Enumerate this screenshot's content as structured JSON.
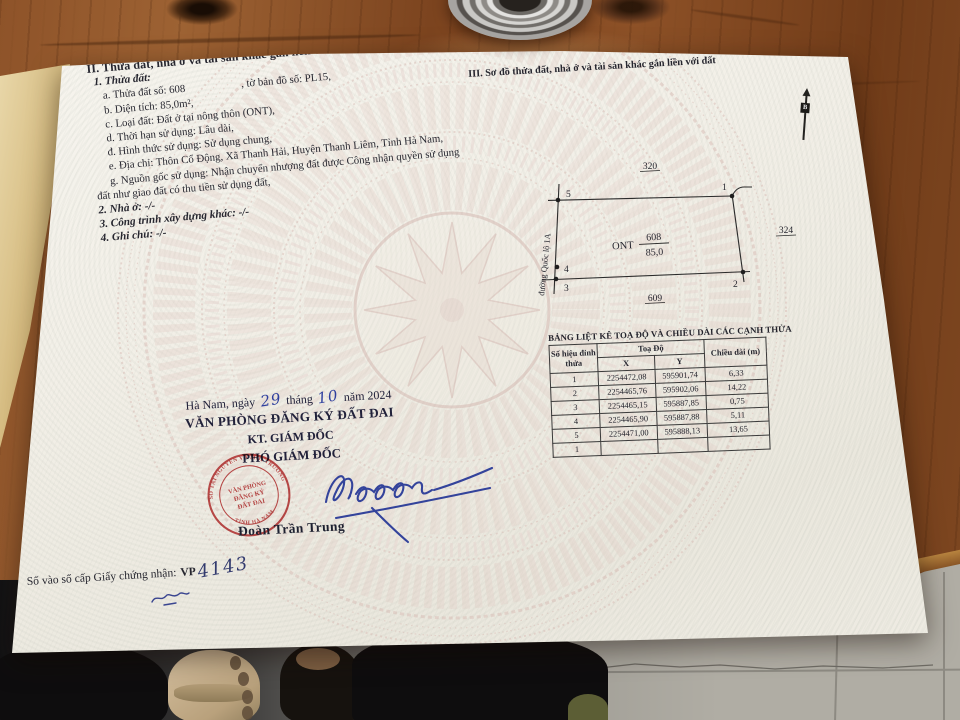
{
  "section2": {
    "heading": "II. Thửa đất, nhà ở và tài sản khác gắn liền với đất",
    "sub1": "1. Thửa đất:",
    "item_a1": "a. Thửa đất số: 608",
    "item_a2": ", tờ bản đồ số: PL15,",
    "item_b": "b. Diện tích: 85,0m²,",
    "item_c": "c. Loại đất: Đất ở tại nông thôn (ONT),",
    "item_d": "d. Thời hạn sử dụng: Lâu dài,",
    "item_dd": "đ. Hình thức sử dụng: Sử dụng chung,",
    "item_e": "e. Địa chỉ: Thôn Cổ Động, Xã Thanh Hải, Huyện Thanh Liêm, Tỉnh Hà Nam,",
    "item_g1": "g. Nguồn gốc sử dụng: Nhận chuyển nhượng đất được Công nhận quyền sử dụng",
    "item_g2": "đất như giao đất có thu tiền sử dụng đất,",
    "sub2": "2. Nhà ở: -/-",
    "sub3": "3. Công trình xây dựng khác: -/-",
    "sub4": "4. Ghi chú: -/-"
  },
  "section3": {
    "heading": "III. Sơ đồ thửa đất, nhà ở và tài sản khác gắn liền với đất",
    "north_label": "B",
    "diagram": {
      "parcel_type": "ONT",
      "parcel_number": "608",
      "parcel_area": "85,0",
      "neighbor_top": "320",
      "neighbor_right": "324",
      "neighbor_bottom": "609",
      "road_label": "đường Quốc lộ 1A",
      "vertex_labels": [
        "1",
        "2",
        "3",
        "4",
        "5"
      ]
    }
  },
  "coord_table": {
    "title": "BẢNG LIỆT KÊ TOẠ ĐỘ VÀ CHIỀU DÀI CÁC CẠNH THỬA",
    "col_vertex": "Số hiệu đỉnh thửa",
    "col_coords": "Toạ Độ",
    "col_x": "X",
    "col_y": "Y",
    "col_length": "Chiều dài (m)",
    "rows": [
      {
        "v": "1",
        "x": "2254472,08",
        "y": "595901,74",
        "len": "6,33"
      },
      {
        "v": "2",
        "x": "2254465,76",
        "y": "595902,06",
        "len": "14,22"
      },
      {
        "v": "3",
        "x": "2254465,15",
        "y": "595887,85",
        "len": "0,75"
      },
      {
        "v": "4",
        "x": "2254465,90",
        "y": "595887,88",
        "len": "5,11"
      },
      {
        "v": "5",
        "x": "2254471,00",
        "y": "595888,13",
        "len": "13,65"
      },
      {
        "v": "1",
        "x": "",
        "y": "",
        "len": ""
      }
    ]
  },
  "signature_block": {
    "date_p1": "Hà Nam, ngày",
    "date_day": "29",
    "date_p2": "tháng",
    "date_month": "10",
    "date_p3": "năm 2024",
    "office": "VĂN PHÒNG ĐĂNG KÝ ĐẤT ĐAI",
    "kt": "KT. GIÁM ĐỐC",
    "role": "PHÓ GIÁM ĐỐC",
    "signer_name": "Đoàn Trần Trung",
    "stamp": {
      "arc_top": "SỞ TÀI NGUYÊN VÀ MÔI TRƯỜNG",
      "arc_bottom": "TỈNH HÀ NAM",
      "center_line1": "VĂN PHÒNG",
      "center_line2": "ĐĂNG KÝ",
      "center_line3": "ĐẤT ĐAI",
      "star": "★"
    }
  },
  "footer": {
    "serial_label": "Số vào sổ cấp Giấy chứng nhận:",
    "serial_prefix": "VP",
    "serial_number": "4143"
  },
  "colors": {
    "stamp_red": "#c03a3c",
    "ink_blue": "#33439b",
    "text_dark": "#26262f",
    "drum_pink": "#d9bdb6"
  }
}
